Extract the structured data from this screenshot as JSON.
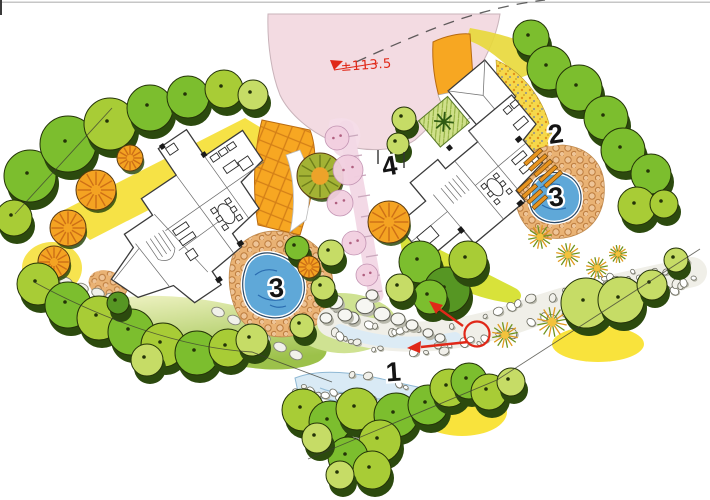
{
  "plan": {
    "type": "hand-drawn landscape site plan, two villas with gardens and stream",
    "elevation_label": "±113.5",
    "markers": {
      "stream": "1",
      "steps_terrace": "2",
      "pond_left": "3",
      "pond_right": "3",
      "garden_path": "4"
    }
  },
  "colors": {
    "paper": "#ffffff",
    "scan_line": "#c6c6c6",
    "road": "#f3dbe2",
    "road_edge": "#c9b3ba",
    "centerline": "#3a3a3a",
    "drive_orange": "#f7a722",
    "drive_hatch": "#cf7a16",
    "cobble_bg": "#e9b274",
    "cobble_ring": "#bc7c3e",
    "speckle_bg": "#f6d84a",
    "yellow_bed": "#f6e03c",
    "lawn_light": "#eef2c2",
    "lawn_dark": "#9cc14a",
    "green_band": "#d8e23a",
    "path_pink": "#f3d9e6",
    "pond_fill": "#5fa8d8",
    "pond_line": "#2a6cb0",
    "pond_rim": "#2d4a66",
    "stream_fill": "#d9eaf5",
    "stream_line": "#93bcd8",
    "rock_band": "#f0efe8",
    "annotation_red": "#e02818",
    "label_ink": "#141414",
    "outline_ink": "#243308",
    "canopy_shadow": "#2c4a0e",
    "canopy": [
      "#7cbe2e",
      "#a8cc36",
      "#c6dc66",
      "#569623"
    ],
    "orn_base": "#f4a322",
    "orn_line": "#cd6f16",
    "olive_base": "#a3b234",
    "olive_line": "#6d7d1a",
    "grass_green": "#6f941e",
    "grass_orange": "#e09a1e",
    "pink_shrub": "#f2cfe0",
    "wall_ink": "#3a3a3a"
  },
  "plantings": [
    [
      30,
      178,
      26,
      0
    ],
    [
      68,
      146,
      28,
      0
    ],
    [
      110,
      126,
      26,
      1
    ],
    [
      150,
      110,
      23,
      0
    ],
    [
      14,
      220,
      18,
      1
    ],
    [
      188,
      99,
      21,
      0
    ],
    [
      224,
      91,
      19,
      1
    ],
    [
      253,
      97,
      15,
      2
    ],
    [
      96,
      190,
      20,
      4
    ],
    [
      68,
      228,
      18,
      4
    ],
    [
      54,
      262,
      16,
      4
    ],
    [
      130,
      158,
      13,
      4
    ],
    [
      320,
      176,
      23,
      7
    ],
    [
      389,
      222,
      21,
      4
    ],
    [
      348,
      170,
      15,
      6
    ],
    [
      340,
      203,
      13,
      6
    ],
    [
      354,
      243,
      12,
      6
    ],
    [
      367,
      275,
      11,
      6
    ],
    [
      337,
      138,
      12,
      6
    ],
    [
      331,
      255,
      13,
      2
    ],
    [
      323,
      290,
      12,
      2
    ],
    [
      302,
      328,
      12,
      2
    ],
    [
      420,
      264,
      21,
      0
    ],
    [
      447,
      292,
      23,
      3
    ],
    [
      430,
      299,
      17,
      0
    ],
    [
      468,
      262,
      19,
      1
    ],
    [
      400,
      290,
      14,
      2
    ],
    [
      297,
      250,
      12,
      0
    ],
    [
      309,
      267,
      11,
      4
    ],
    [
      531,
      40,
      18,
      0
    ],
    [
      549,
      70,
      22,
      0
    ],
    [
      579,
      90,
      23,
      0
    ],
    [
      606,
      120,
      22,
      0
    ],
    [
      623,
      152,
      22,
      0
    ],
    [
      651,
      176,
      20,
      0
    ],
    [
      637,
      208,
      19,
      1
    ],
    [
      664,
      206,
      14,
      1
    ],
    [
      404,
      121,
      12,
      2
    ],
    [
      398,
      146,
      11,
      2
    ],
    [
      540,
      237,
      12,
      5
    ],
    [
      568,
      255,
      12,
      5
    ],
    [
      597,
      268,
      11,
      5
    ],
    [
      552,
      322,
      15,
      5
    ],
    [
      505,
      335,
      13,
      5
    ],
    [
      618,
      254,
      9,
      5
    ],
    [
      586,
      305,
      25,
      2
    ],
    [
      621,
      302,
      23,
      2
    ],
    [
      652,
      287,
      15,
      2
    ],
    [
      676,
      262,
      12,
      2
    ],
    [
      38,
      286,
      21,
      1
    ],
    [
      68,
      307,
      23,
      0
    ],
    [
      99,
      320,
      22,
      1
    ],
    [
      131,
      334,
      23,
      0
    ],
    [
      163,
      347,
      22,
      1
    ],
    [
      197,
      355,
      22,
      0
    ],
    [
      228,
      350,
      19,
      1
    ],
    [
      252,
      342,
      16,
      2
    ],
    [
      118,
      305,
      11,
      3
    ],
    [
      147,
      362,
      16,
      2
    ],
    [
      303,
      412,
      21,
      1
    ],
    [
      330,
      424,
      21,
      0
    ],
    [
      357,
      411,
      21,
      1
    ],
    [
      396,
      417,
      22,
      0
    ],
    [
      380,
      443,
      21,
      1
    ],
    [
      348,
      459,
      20,
      0
    ],
    [
      372,
      472,
      19,
      1
    ],
    [
      428,
      407,
      20,
      0
    ],
    [
      449,
      390,
      19,
      1
    ],
    [
      469,
      383,
      18,
      0
    ],
    [
      489,
      394,
      18,
      1
    ],
    [
      511,
      384,
      14,
      2
    ],
    [
      340,
      477,
      14,
      2
    ],
    [
      317,
      440,
      15,
      2
    ]
  ]
}
